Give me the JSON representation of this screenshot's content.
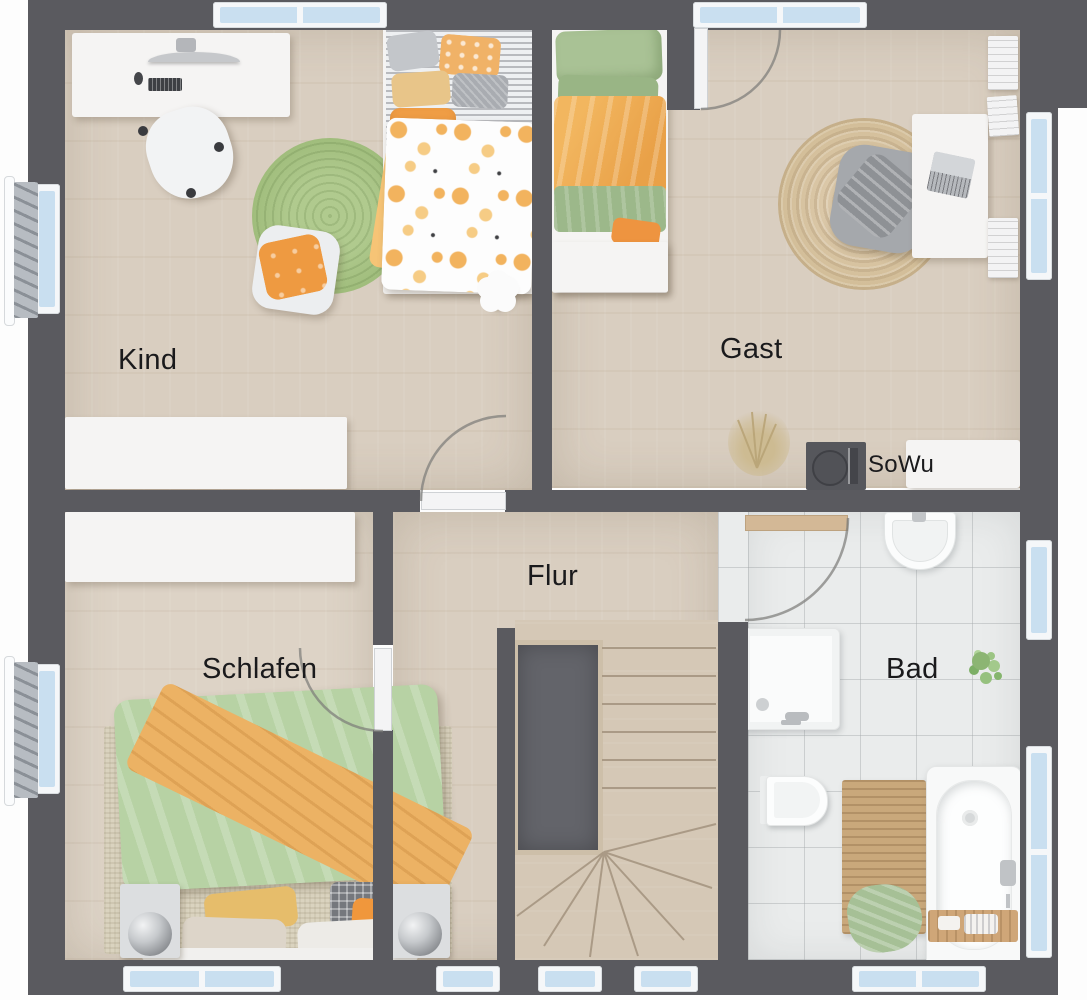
{
  "rooms": {
    "kind": {
      "label": "Kind"
    },
    "gast": {
      "label": "Gast"
    },
    "flur": {
      "label": "Flur"
    },
    "schlafen": {
      "label": "Schlafen"
    },
    "bad": {
      "label": "Bad"
    }
  },
  "annotations": {
    "sowu": {
      "label": "SoWu"
    }
  },
  "palette": {
    "wall": "#5a5a5f",
    "wood_floor": "#d9cec0",
    "tile_floor": "#eaecec",
    "window_glass": "#c9dff0",
    "window_frame": "#f5f7f9",
    "stairwell_void": "#63646a",
    "accent_orange": "#efa14c",
    "accent_green": "#aac793",
    "jute_rug": "#d6c2a0",
    "green_rug": "#a0bd7c",
    "label_text": "#1a1a1c"
  }
}
